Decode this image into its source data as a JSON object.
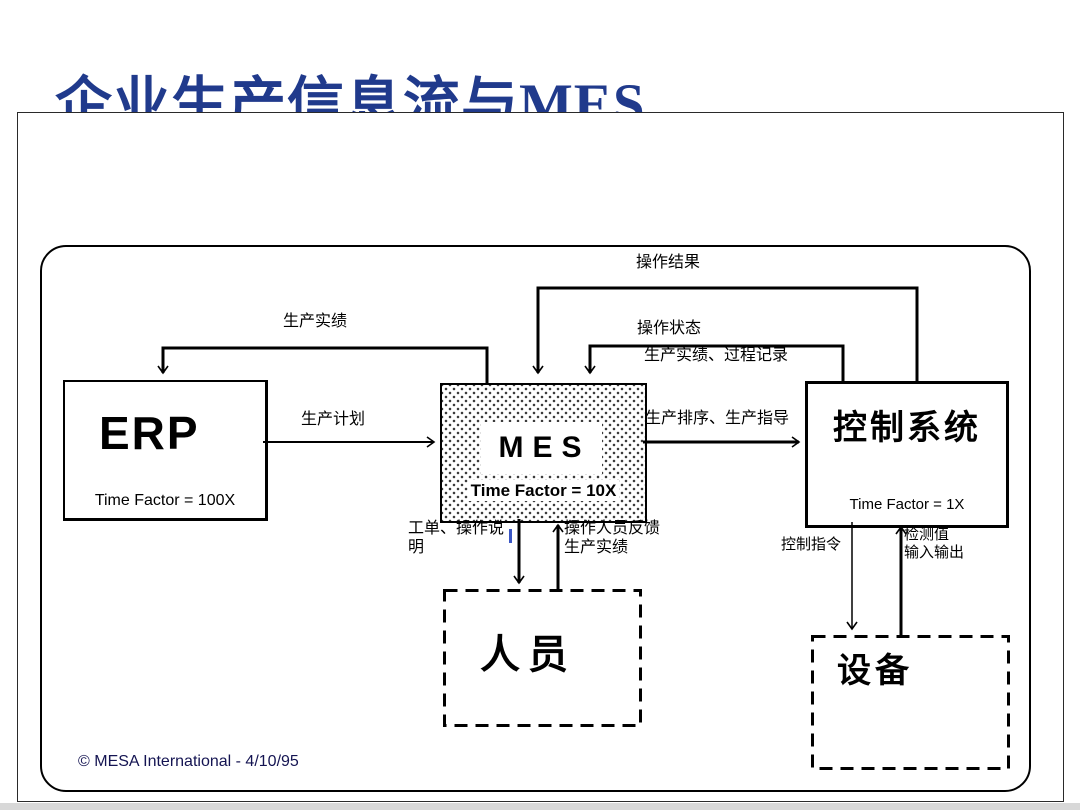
{
  "page": {
    "title": "企业生产信息流与MES",
    "footer": "© MESA International - 4/10/95"
  },
  "boxes": {
    "erp": {
      "label": "ERP",
      "time_factor": "Time Factor = 100X"
    },
    "mes": {
      "label": "MES",
      "time_factor": "Time Factor = 10X"
    },
    "control": {
      "label": "控制系统",
      "time_factor": "Time Factor = 1X"
    },
    "personnel": {
      "label": "人员"
    },
    "equipment": {
      "label": "设备"
    }
  },
  "flows": {
    "production_performance": "生产实绩",
    "production_plan": "生产计划",
    "operation_result": "操作结果",
    "operation_status": "操作状态",
    "performance_process_record": "生产实绩、过程记录",
    "sequencing_guidance": "生产排序、生产指导",
    "work_order": "工单、操作说明",
    "operator_feedback_line1": "操作人员反馈",
    "operator_feedback_line2": "生产实绩",
    "control_command": "控制指令",
    "detection_line1": "检测值",
    "detection_line2": "输入输出"
  },
  "colors": {
    "title": "#203a8c",
    "footer": "#141452",
    "line": "#000000",
    "mes_stipple": "#3c3c3c"
  }
}
